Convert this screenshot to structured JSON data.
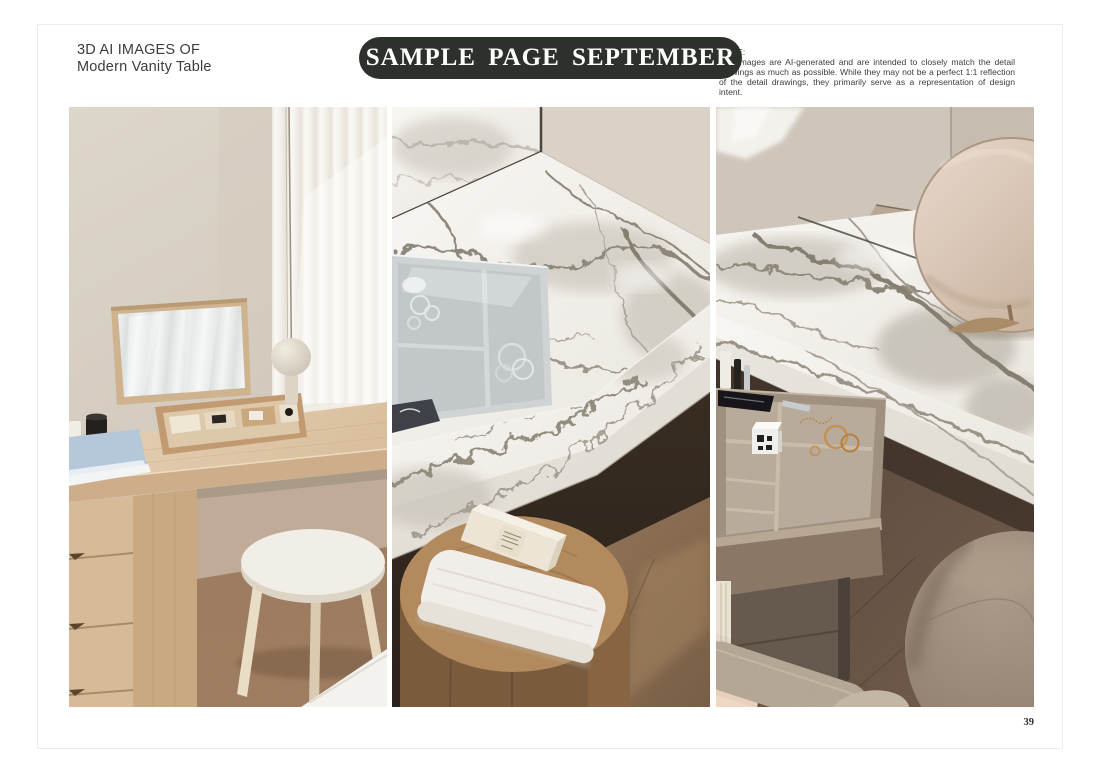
{
  "page": {
    "title_line1": "3D AI IMAGES OF",
    "title_line2": "Modern Vanity Table",
    "banner_label": "SAMPLE PAGE SEPTEMBER",
    "disclaimer_heading": "NOTE:",
    "disclaimer_body": "The images are AI-generated and are intended to closely match the detail drawings as much as possible. While they may not be a perfect 1:1 reflection of the detail drawings, they primarily serve as a representation of design intent.",
    "page_number": "39"
  },
  "colors": {
    "banner_bg": "#2d312c",
    "banner_text": "#ffffff",
    "title_text": "#3d3d3d",
    "disclaimer_text": "#3c3c3c",
    "page_bg": "#ffffff",
    "page_border": "#ececec"
  },
  "images": [
    {
      "name": "vanity-desk-photo",
      "alt": "Light oak vanity desk with flip-up mirror lid, open cosmetics organizer, beige table lamp, sheer curtains and a round white stool"
    },
    {
      "name": "marble-counter-photo",
      "alt": "White marble vanity counter with recessed glass-top jewelry tray above a wooden stool holding a folded towel and a skincare box"
    },
    {
      "name": "marble-drawer-photo",
      "alt": "Marble vanity top with round table mirror, open pull-out jewelry drawer and a round beige fabric pouf"
    }
  ]
}
